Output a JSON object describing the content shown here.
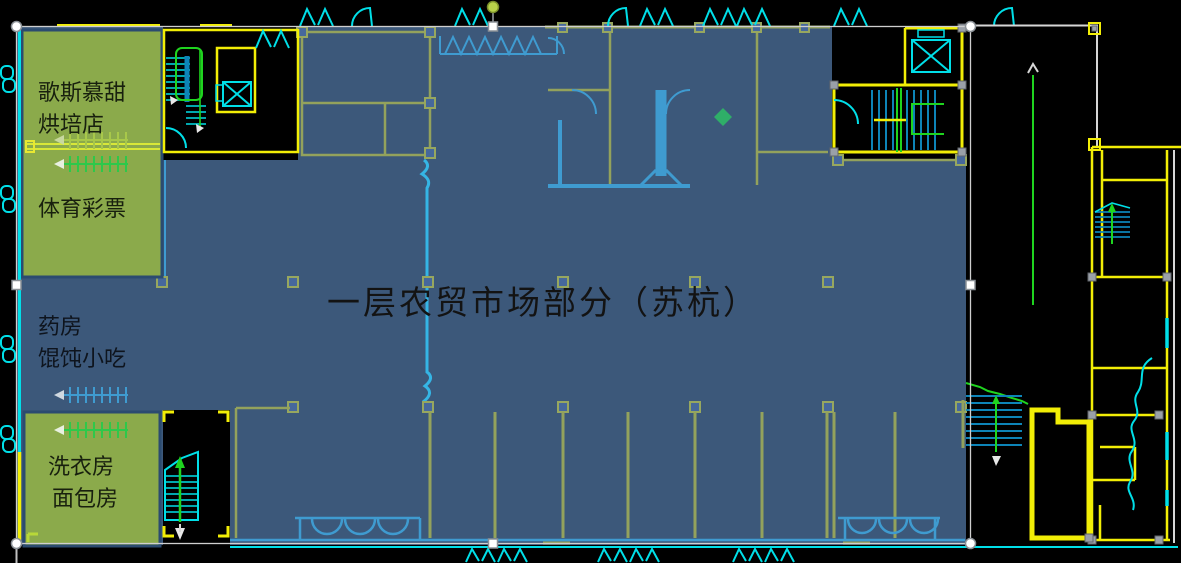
{
  "title": {
    "text": "一层农贸市场部分（苏杭）"
  },
  "shops": {
    "bakery_line1": "歌斯慕甜",
    "bakery_line2": "烘培店",
    "lottery": "体育彩票",
    "pharmacy_line1": "药房",
    "pharmacy_line2": "馄饨小吃",
    "laundry_line1": "洗衣房",
    "laundry_line2": "面包房"
  },
  "colors": {
    "background": "#000000",
    "overlay_blue": "#3c587a",
    "highlight_green_box": "#8baa4b",
    "green_box_border": "#2b4b70",
    "cad_yellow": "#f2ee06",
    "cad_cyan": "#00dfe8",
    "cad_green": "#1fd41f",
    "cad_white": "#d6d6d6",
    "tinted_wall_olive": "#93a25c",
    "tinted_wall_cyan": "#3f9bd0",
    "selection_handle": "#ffffff",
    "rotate_knob": "#b9d34a"
  }
}
